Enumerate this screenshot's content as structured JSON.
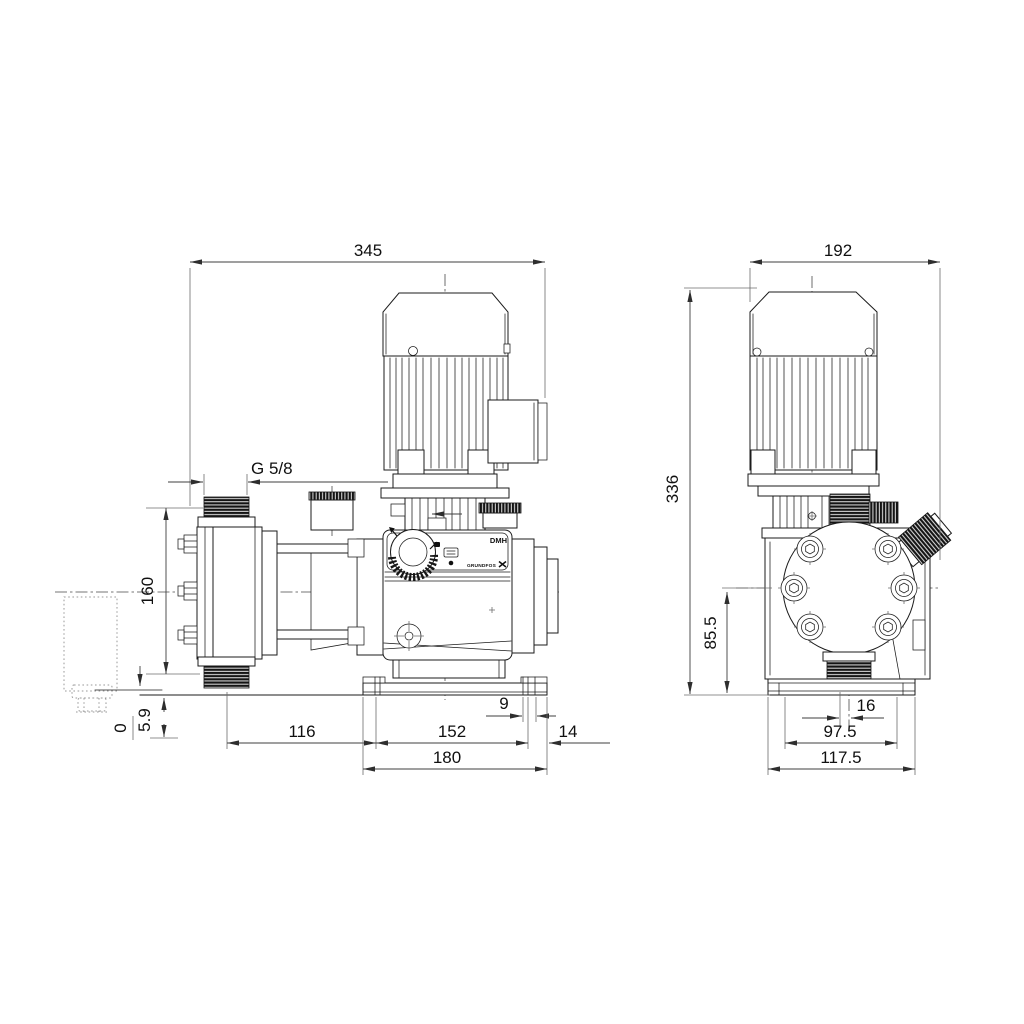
{
  "drawing_labels": {
    "model": "DMH",
    "brand": "GRUNDFOS"
  },
  "side_view": {
    "dims": {
      "overall_width": "345",
      "valve_thread": "G 5/8",
      "head_height": "160",
      "zero_ref": "0",
      "base_clearance": "5.9",
      "slot_width": "9",
      "valve_to_base": "116",
      "mount_spacing": "152",
      "flange_overhang": "14",
      "base_length": "180"
    }
  },
  "front_view": {
    "dims": {
      "overall_width": "192",
      "overall_height": "336",
      "axis_height": "85.5",
      "axis_offset": "16",
      "mount_spacing": "97.5",
      "base_width": "117.5"
    }
  }
}
